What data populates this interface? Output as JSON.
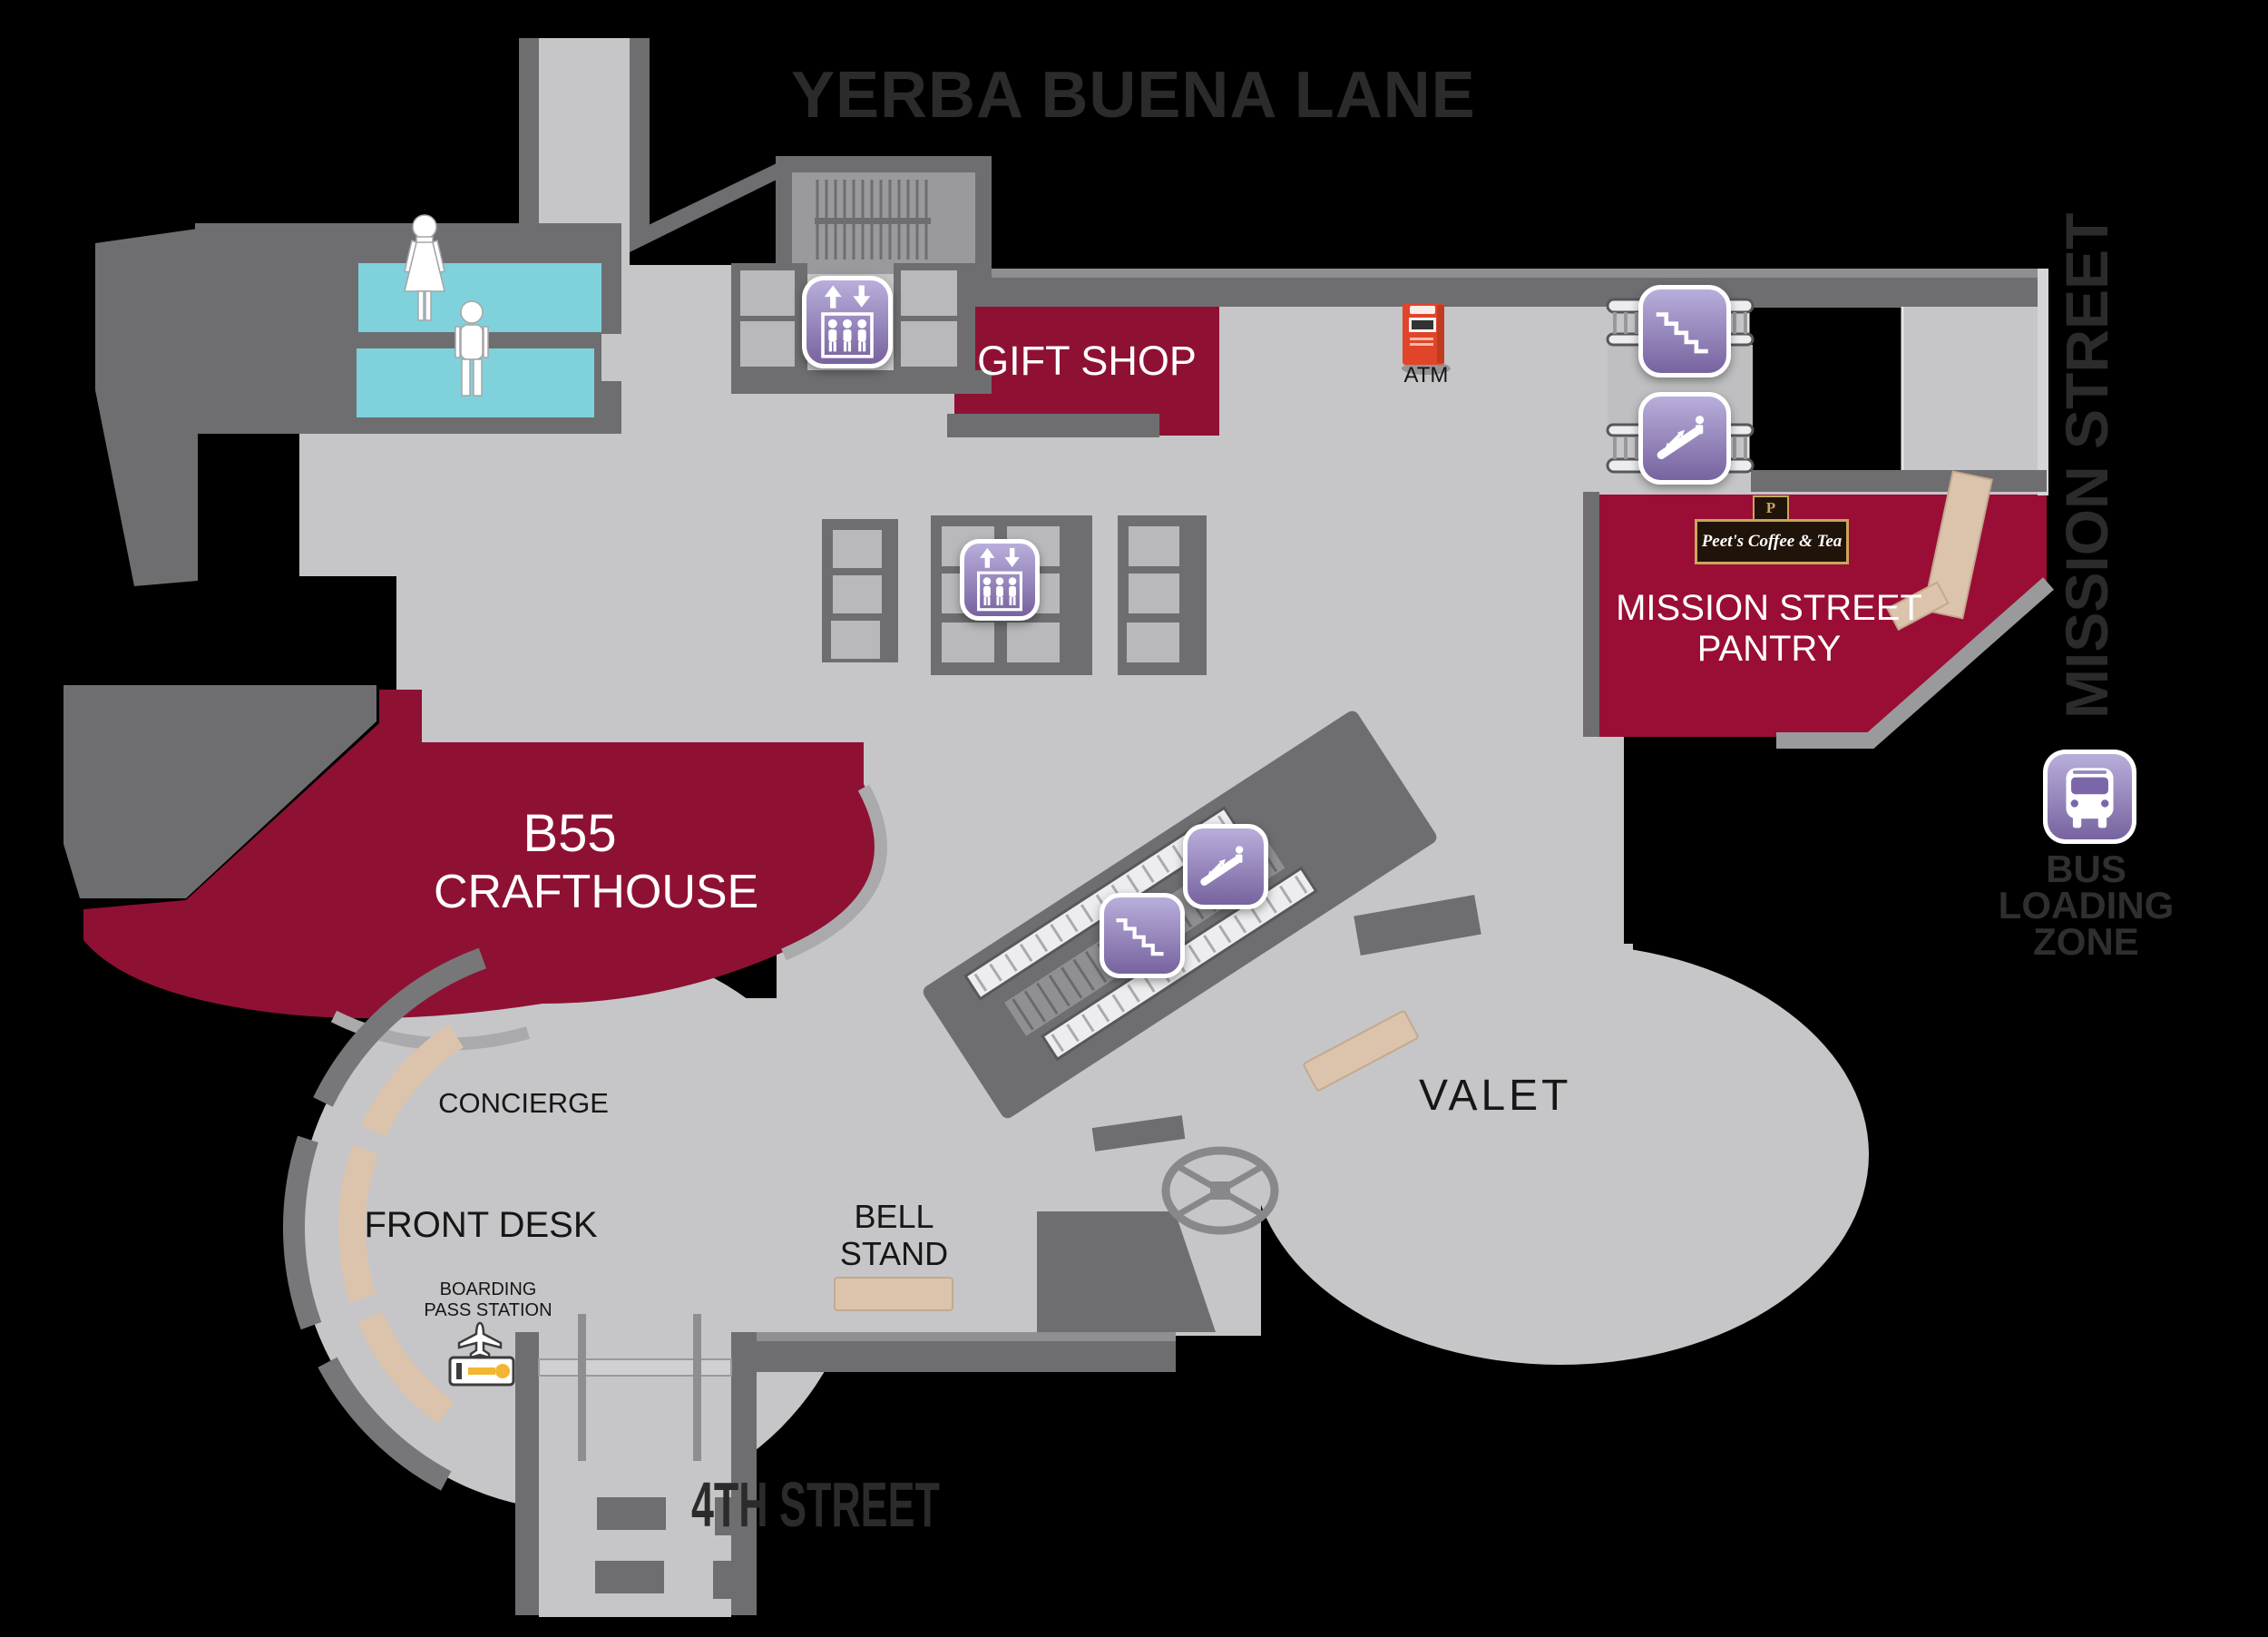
{
  "map": {
    "title": "Hotel lobby level floor plan",
    "streets": {
      "top": "YERBA BUENA LANE",
      "right": "MISSION STREET",
      "bottom": "4TH STREET"
    },
    "venues": {
      "gift_shop": {
        "label": "GIFT SHOP"
      },
      "pantry": {
        "line1": "MISSION STREET",
        "line2": "PANTRY",
        "brand": "Peet's Coffee & Tea",
        "brand_initial": "P"
      },
      "crafthouse": {
        "line1": "B55",
        "line2": "CRAFTHOUSE"
      }
    },
    "stations": {
      "concierge": "CONCIERGE",
      "front_desk": "FRONT DESK",
      "boarding_pass": {
        "line1": "BOARDING",
        "line2": "PASS STATION"
      },
      "bell_stand": {
        "line1": "BELL",
        "line2": "STAND"
      },
      "valet": "VALET",
      "atm": "ATM",
      "bus_loading": {
        "line1": "BUS",
        "line2": "LOADING",
        "line3": "ZONE"
      }
    },
    "icons": {
      "elevator": "elevator",
      "stairs": "stairs",
      "escalator": "escalator",
      "bus": "bus",
      "restroom_women": "women-restroom",
      "restroom_men": "men-restroom",
      "atm_machine": "atm-machine",
      "boarding_pass_kiosk": "boarding-pass-kiosk",
      "revolving_door": "revolving-door"
    }
  },
  "colors": {
    "bg": "#000000",
    "floor": "#c6c6c8",
    "floor_mid": "#9a9a9d",
    "wall": "#6e6e71",
    "wall_light": "#8f8f92",
    "wall_edge": "#d5d5d7",
    "venue_red": "#8e1134",
    "pantry_red": "#9a0e36",
    "restroom_cyan": "#7fd2db",
    "desk_tan": "#dcc3ab",
    "desk_tan_edge": "#c2a98f",
    "icon_purple_light": "#b9aedb",
    "icon_purple_dark": "#77639f",
    "street_text": "#2b2b2b",
    "label_text": "#161616",
    "white": "#ffffff",
    "atm_red": "#e0452a",
    "peets_brown": "#20130a",
    "peets_gold": "#c9a55c"
  }
}
